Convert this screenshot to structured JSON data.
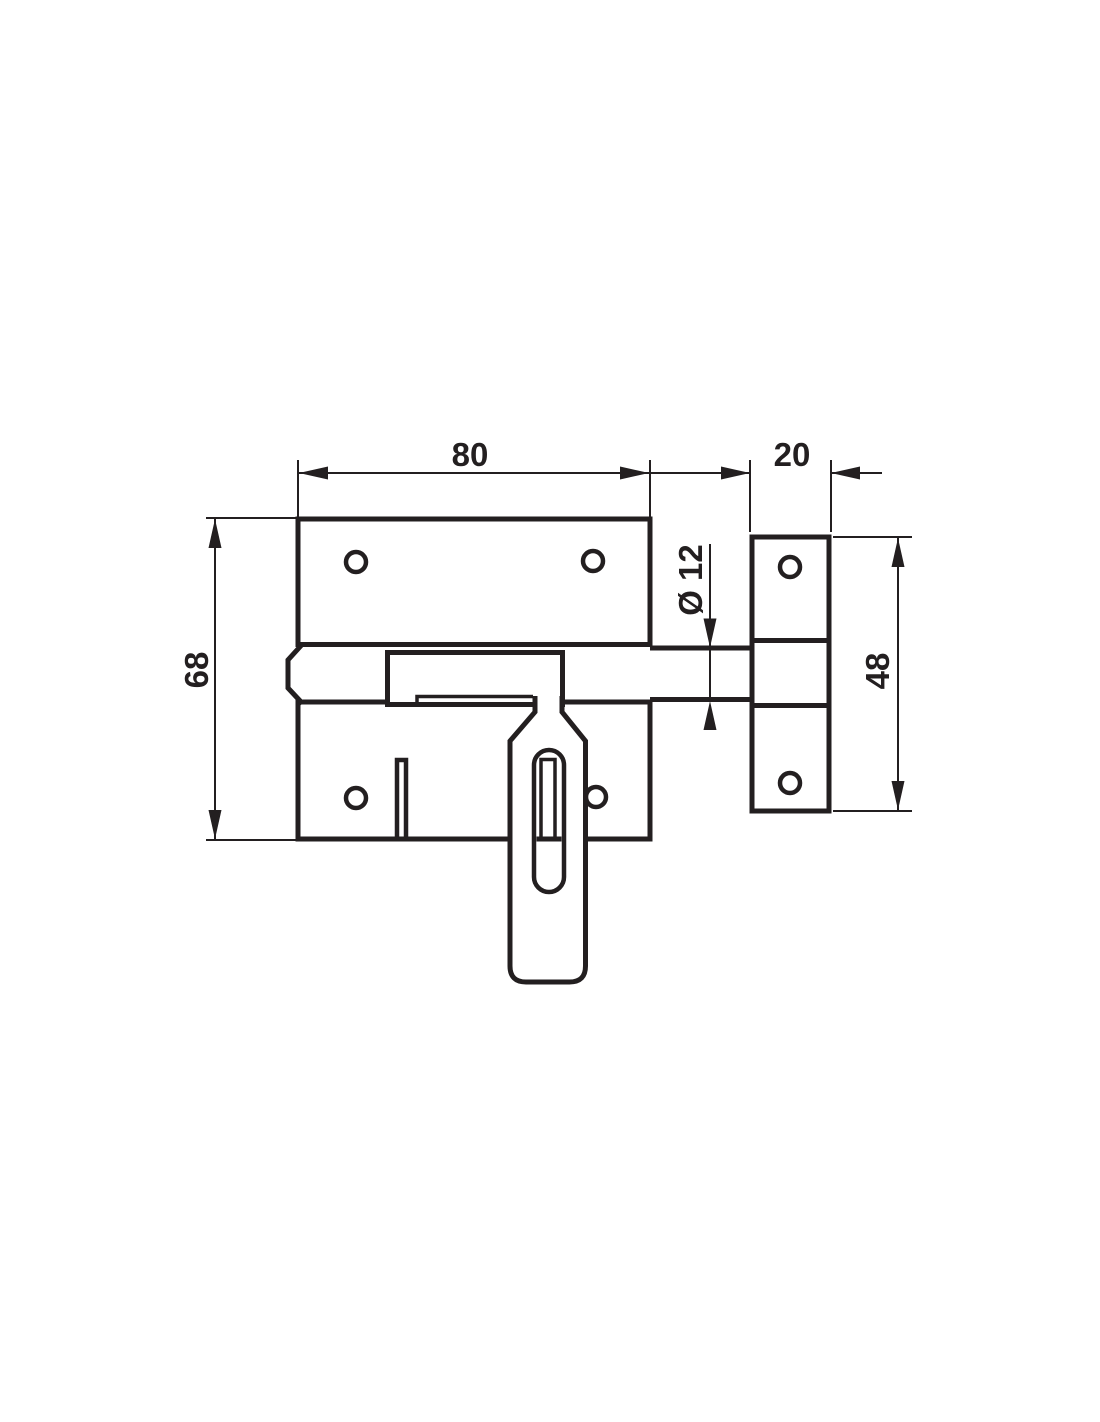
{
  "drawing": {
    "background_color": "#ffffff",
    "ink_color": "#231f20",
    "dimensions": {
      "plate_width": "80",
      "keeper_width": "20",
      "plate_height": "68",
      "keeper_height": "48",
      "bolt_diameter": "Ø 12"
    }
  }
}
